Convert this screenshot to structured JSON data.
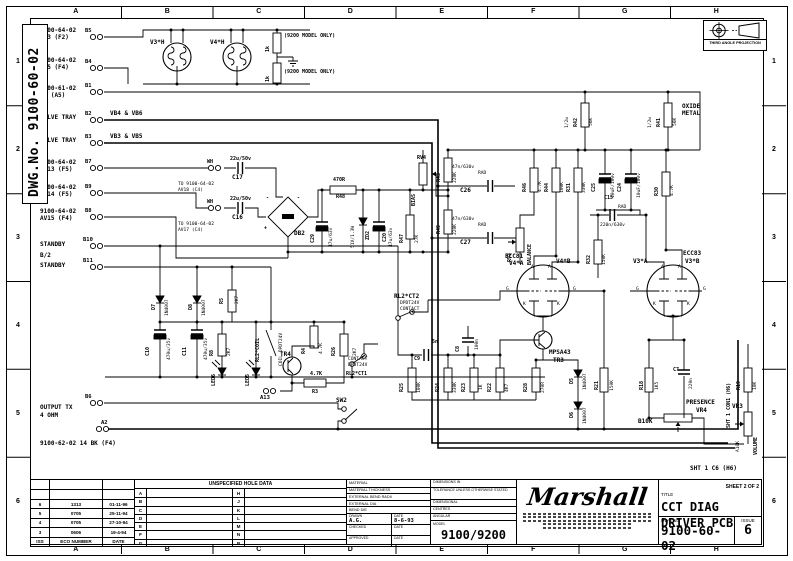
{
  "frame": {
    "columns": [
      "A",
      "B",
      "C",
      "D",
      "E",
      "F",
      "G",
      "H"
    ],
    "rows": [
      "1",
      "2",
      "3",
      "4",
      "5",
      "6"
    ],
    "dwg_box": "DWG.No. 9100-60-02",
    "projection": "THIRD ANGLE PROJECTION"
  },
  "title_block": {
    "title_label": "TITLE",
    "title_line1": "CCT DIAG",
    "title_line2": "DRIVER PCB",
    "sheet": "SHEET 2 OF 2",
    "dwg_label": "DWG.No",
    "dwg_no": "9100-60-02",
    "issue_label": "ISSUE",
    "issue": "6",
    "model_label": "MODEL",
    "model": "9100/9200",
    "logo": "Marshall",
    "material_rows": [
      "MATERIAL",
      "MATERIAL THICKNESS",
      "EXTERNAL BEND RADII",
      "EXTERNAL DIA",
      "BEND DIE"
    ],
    "drawn_label": "DRAWN",
    "drawn": "A.G.",
    "date_label": "DATE",
    "drawn_date": "8-6-93",
    "checked_label": "CHECKED",
    "approved_label": "APPROVED",
    "dims_rows": [
      "DIMENSIONS IN",
      "TOLERANCE UNLESS OTHERWISE STATED",
      "DIMENSIONAL",
      "CENTRES",
      "ANGULAR"
    ]
  },
  "eco_table": {
    "headers": [
      "ISS",
      "ECO NUMBER",
      "DATE"
    ],
    "rows": [
      [
        "6",
        "1313",
        "01-11-96"
      ],
      [
        "5",
        "0705",
        "25-11-94"
      ],
      [
        "4",
        "0705",
        "27-10-94"
      ],
      [
        "3",
        "0606",
        "19-4-94"
      ]
    ]
  },
  "hole_table": {
    "title": "UNSPECIFIED HOLE DATA",
    "left_letters": [
      "A",
      "B",
      "C",
      "D",
      "E",
      "F",
      "G"
    ],
    "right_letters": [
      "H",
      "J",
      "K",
      "L",
      "M",
      "N",
      "P"
    ]
  },
  "schematic": {
    "labels": [
      [
        "9100-64-02",
        40,
        28
      ],
      [
        "AV3 (F2)",
        40,
        35
      ],
      [
        "B5",
        85,
        29,
        "p"
      ],
      [
        "9100-64-02",
        40,
        58
      ],
      [
        "AV5 (F4)",
        40,
        65
      ],
      [
        "B4",
        85,
        60,
        "p"
      ],
      [
        "9100-61-02",
        40,
        86
      ],
      [
        "16 (A5)",
        40,
        93
      ],
      [
        "B1",
        85,
        84,
        "p"
      ],
      [
        "VALVE TRAY",
        40,
        115
      ],
      [
        "B2",
        85,
        112,
        "p"
      ],
      [
        "VB4 & VB6",
        110,
        111
      ],
      [
        "VALVE TRAY",
        40,
        138
      ],
      [
        "B3",
        85,
        135,
        "p"
      ],
      [
        "VB3 & VB5",
        110,
        134
      ],
      [
        "9100-64-02",
        40,
        160
      ],
      [
        "AV13 (F5)",
        40,
        167
      ],
      [
        "B7",
        85,
        160,
        "p"
      ],
      [
        "9100-64-02",
        40,
        185
      ],
      [
        "AV14 (F5)",
        40,
        192
      ],
      [
        "B9",
        85,
        185,
        "p"
      ],
      [
        "9100-64-02",
        40,
        209
      ],
      [
        "AV15 (F4)",
        40,
        216
      ],
      [
        "B8",
        85,
        209,
        "p"
      ],
      [
        "STANDBY",
        40,
        242
      ],
      [
        "B10",
        83,
        238,
        "p"
      ],
      [
        "B/2",
        40,
        253
      ],
      [
        "STANDBY",
        40,
        263
      ],
      [
        "B11",
        83,
        259,
        "p"
      ],
      [
        "OUTPUT TX",
        40,
        405
      ],
      [
        "4 OHM",
        40,
        413
      ],
      [
        "B6",
        85,
        395,
        "p"
      ],
      [
        "A2",
        101,
        421,
        "p"
      ],
      [
        "9100-62-02 14 BK (F4)",
        40,
        441
      ],
      [
        "V3*H",
        150,
        40
      ],
      [
        "V4*H",
        210,
        40
      ],
      [
        "1k",
        266,
        52,
        "v s"
      ],
      [
        "1k",
        266,
        82,
        "v s"
      ],
      [
        "(9200 MODEL ONLY)",
        284,
        34,
        "s"
      ],
      [
        "(9200 MODEL ONLY)",
        284,
        70,
        "s"
      ],
      [
        "WH",
        207,
        160,
        "s"
      ],
      [
        "22u/50v",
        230,
        157,
        "s"
      ],
      [
        "C17",
        232,
        175
      ],
      [
        "TO 9100-64-02",
        178,
        183,
        "t"
      ],
      [
        "AV18 (C4)",
        178,
        189,
        "t"
      ],
      [
        "WH",
        207,
        200,
        "s"
      ],
      [
        "22u/50v",
        230,
        197,
        "s"
      ],
      [
        "C16",
        232,
        215
      ],
      [
        "TO 9100-64-02",
        178,
        223,
        "t"
      ],
      [
        "AV17 (C4)",
        178,
        229,
        "t"
      ],
      [
        "DB2",
        294,
        231
      ],
      [
        "-",
        266,
        196,
        "s"
      ],
      [
        "-",
        297,
        196,
        "s"
      ],
      [
        "+",
        264,
        226,
        "s"
      ],
      [
        "470R",
        333,
        178,
        "s"
      ],
      [
        "R48",
        336,
        195,
        "s"
      ],
      [
        "C29",
        311,
        243,
        "v s"
      ],
      [
        "47u/63v",
        330,
        247,
        "v t"
      ],
      [
        "51V/1.3W",
        352,
        248,
        "v t"
      ],
      [
        "ZD2",
        366,
        240,
        "v s"
      ],
      [
        "C20",
        383,
        242,
        "v s"
      ],
      [
        "47u/63v",
        390,
        247,
        "v t"
      ],
      [
        "R47",
        400,
        243,
        "v s"
      ],
      [
        "27K",
        416,
        243,
        "v t"
      ],
      [
        "BIAS",
        412,
        206,
        "v s"
      ],
      [
        "RV4",
        417,
        156,
        "s"
      ],
      [
        "R43",
        437,
        182,
        "v s"
      ],
      [
        "220K",
        454,
        183,
        "v t"
      ],
      [
        "R45",
        437,
        234,
        "v s"
      ],
      [
        "220K",
        454,
        235,
        "v t"
      ],
      [
        "47n/630v",
        452,
        166,
        "t"
      ],
      [
        "RAD",
        478,
        172,
        "t"
      ],
      [
        "C26",
        460,
        188
      ],
      [
        "47n/630v",
        452,
        218,
        "t"
      ],
      [
        "RAD",
        478,
        224,
        "t"
      ],
      [
        "C27",
        460,
        240
      ],
      [
        "RV3",
        508,
        262,
        "v s"
      ],
      [
        "BALANCE",
        528,
        265,
        "v s"
      ],
      [
        "R46",
        523,
        192,
        "v s"
      ],
      [
        "4.7K",
        539,
        192,
        "v t"
      ],
      [
        "R44",
        545,
        192,
        "v s"
      ],
      [
        "100K",
        561,
        193,
        "v t"
      ],
      [
        "R31",
        567,
        192,
        "v s"
      ],
      [
        "330K",
        583,
        193,
        "v t"
      ],
      [
        "C25",
        592,
        192,
        "v s"
      ],
      [
        "10uF/100v",
        612,
        198,
        "v t"
      ],
      [
        "C24",
        618,
        192,
        "v s"
      ],
      [
        "10uF/100v",
        638,
        198,
        "v t"
      ],
      [
        "R30",
        655,
        196,
        "v s"
      ],
      [
        "4.7K",
        671,
        196,
        "v t"
      ],
      [
        "R42",
        574,
        127,
        "v s"
      ],
      [
        "56K",
        590,
        126,
        "v t"
      ],
      [
        "1/2w",
        566,
        128,
        "v t"
      ],
      [
        "R41",
        657,
        127,
        "v s"
      ],
      [
        "56K",
        674,
        126,
        "v t"
      ],
      [
        "1/2w",
        649,
        128,
        "v t"
      ],
      [
        "OXIDE",
        682,
        104
      ],
      [
        "METAL",
        682,
        111
      ],
      [
        "C15",
        604,
        196,
        "s"
      ],
      [
        "RAD",
        618,
        206,
        "t"
      ],
      [
        "220n/630v",
        600,
        224,
        "t"
      ],
      [
        "R32",
        587,
        264,
        "v s"
      ],
      [
        "150K",
        603,
        265,
        "v t"
      ],
      [
        "ECC81",
        505,
        254
      ],
      [
        "V4*A",
        509,
        261
      ],
      [
        "V4*B",
        556,
        259
      ],
      [
        "A",
        531,
        266,
        "t"
      ],
      [
        "A",
        548,
        266,
        "t"
      ],
      [
        "G",
        506,
        288,
        "t"
      ],
      [
        "G",
        573,
        288,
        "t"
      ],
      [
        "K",
        523,
        303,
        "t"
      ],
      [
        "K",
        557,
        303,
        "t"
      ],
      [
        "V3*A",
        633,
        259
      ],
      [
        "ECC83",
        683,
        251
      ],
      [
        "V3*B",
        685,
        259
      ],
      [
        "A",
        661,
        266,
        "t"
      ],
      [
        "A",
        678,
        266,
        "t"
      ],
      [
        "G",
        636,
        288,
        "t"
      ],
      [
        "G",
        703,
        288,
        "t"
      ],
      [
        "K",
        653,
        303,
        "t"
      ],
      [
        "K",
        687,
        303,
        "t"
      ],
      [
        "MPSA43",
        549,
        350
      ],
      [
        "TR3",
        553,
        358
      ],
      [
        "D5",
        570,
        384,
        "v s"
      ],
      [
        "1N4007",
        584,
        390,
        "v t"
      ],
      [
        "R21",
        595,
        390,
        "v s"
      ],
      [
        "150K",
        611,
        391,
        "v t"
      ],
      [
        "R18",
        640,
        390,
        "v s"
      ],
      [
        "1K5",
        656,
        390,
        "v t"
      ],
      [
        "C7",
        673,
        368,
        "s"
      ],
      [
        "220n",
        690,
        389,
        "v t"
      ],
      [
        "R19",
        737,
        390,
        "v s"
      ],
      [
        "10K",
        754,
        390,
        "v t"
      ],
      [
        "D6",
        570,
        418,
        "v s"
      ],
      [
        "1N4007",
        584,
        424,
        "v t"
      ],
      [
        "PRESENCE",
        686,
        400
      ],
      [
        "VR4",
        696,
        408
      ],
      [
        "B10K",
        638,
        419
      ],
      [
        "VR3",
        732,
        404
      ],
      [
        "VOLUME",
        754,
        455,
        "v s"
      ],
      [
        "A10K",
        737,
        452,
        "v t"
      ],
      [
        "D7",
        152,
        310,
        "v s"
      ],
      [
        "1N4007",
        166,
        316,
        "v t"
      ],
      [
        "D8",
        189,
        310,
        "v s"
      ],
      [
        "1N4007",
        203,
        316,
        "v t"
      ],
      [
        "R5",
        220,
        304,
        "v s"
      ],
      [
        "2K7",
        236,
        304,
        "v t"
      ],
      [
        "C10",
        146,
        356,
        "v s"
      ],
      [
        "470u/35v",
        168,
        360,
        "v t"
      ],
      [
        "C11",
        183,
        356,
        "v s"
      ],
      [
        "470u/35v",
        205,
        360,
        "v t"
      ],
      [
        "R8",
        210,
        356,
        "v s"
      ],
      [
        "2K7",
        228,
        356,
        "v t"
      ],
      [
        "RL2*COIL",
        256,
        362,
        "v s"
      ],
      [
        "COIL DPDT24V",
        280,
        366,
        "v t"
      ],
      [
        "LED6",
        212,
        386,
        "v s"
      ],
      [
        "LED5",
        246,
        386,
        "v s"
      ],
      [
        "A13",
        260,
        396,
        "p"
      ],
      [
        "TR4",
        280,
        352
      ],
      [
        "R3",
        312,
        390,
        "s"
      ],
      [
        "4.7K",
        310,
        372,
        "s"
      ],
      [
        "R4",
        302,
        354,
        "v s"
      ],
      [
        "4.7K",
        320,
        354,
        "v t"
      ],
      [
        "R26",
        332,
        356,
        "v s"
      ],
      [
        "2K7",
        354,
        356,
        "v t"
      ],
      [
        "CONTACT",
        348,
        358,
        "t"
      ],
      [
        "DPDT24V",
        348,
        364,
        "t"
      ],
      [
        "RL2*CT1",
        346,
        372,
        "s"
      ],
      [
        "SW2",
        336,
        398
      ],
      [
        "RL2*CT2",
        394,
        294
      ],
      [
        "DPDT24V",
        400,
        302,
        "t"
      ],
      [
        "CONTACT",
        400,
        308,
        "t"
      ],
      [
        "5n",
        432,
        340,
        "s"
      ],
      [
        "C9",
        414,
        357,
        "s"
      ],
      [
        "C8",
        456,
        352,
        "v s"
      ],
      [
        "100n",
        476,
        350,
        "v t"
      ],
      [
        "R25",
        400,
        392,
        "v s"
      ],
      [
        "100K",
        418,
        393,
        "v t"
      ],
      [
        "R24",
        436,
        392,
        "v s"
      ],
      [
        "330K",
        454,
        393,
        "v t"
      ],
      [
        "R23",
        462,
        392,
        "v s"
      ],
      [
        "1K",
        480,
        390,
        "v t"
      ],
      [
        "R22",
        488,
        392,
        "v s"
      ],
      [
        "4K7",
        506,
        392,
        "v t"
      ],
      [
        "R28",
        524,
        392,
        "v s"
      ],
      [
        "270R",
        542,
        393,
        "v t"
      ],
      [
        "SHT 1 C6 (H6)",
        690,
        466
      ],
      [
        "SHT 1 CON1 (H6)",
        727,
        428,
        "v s"
      ]
    ]
  }
}
